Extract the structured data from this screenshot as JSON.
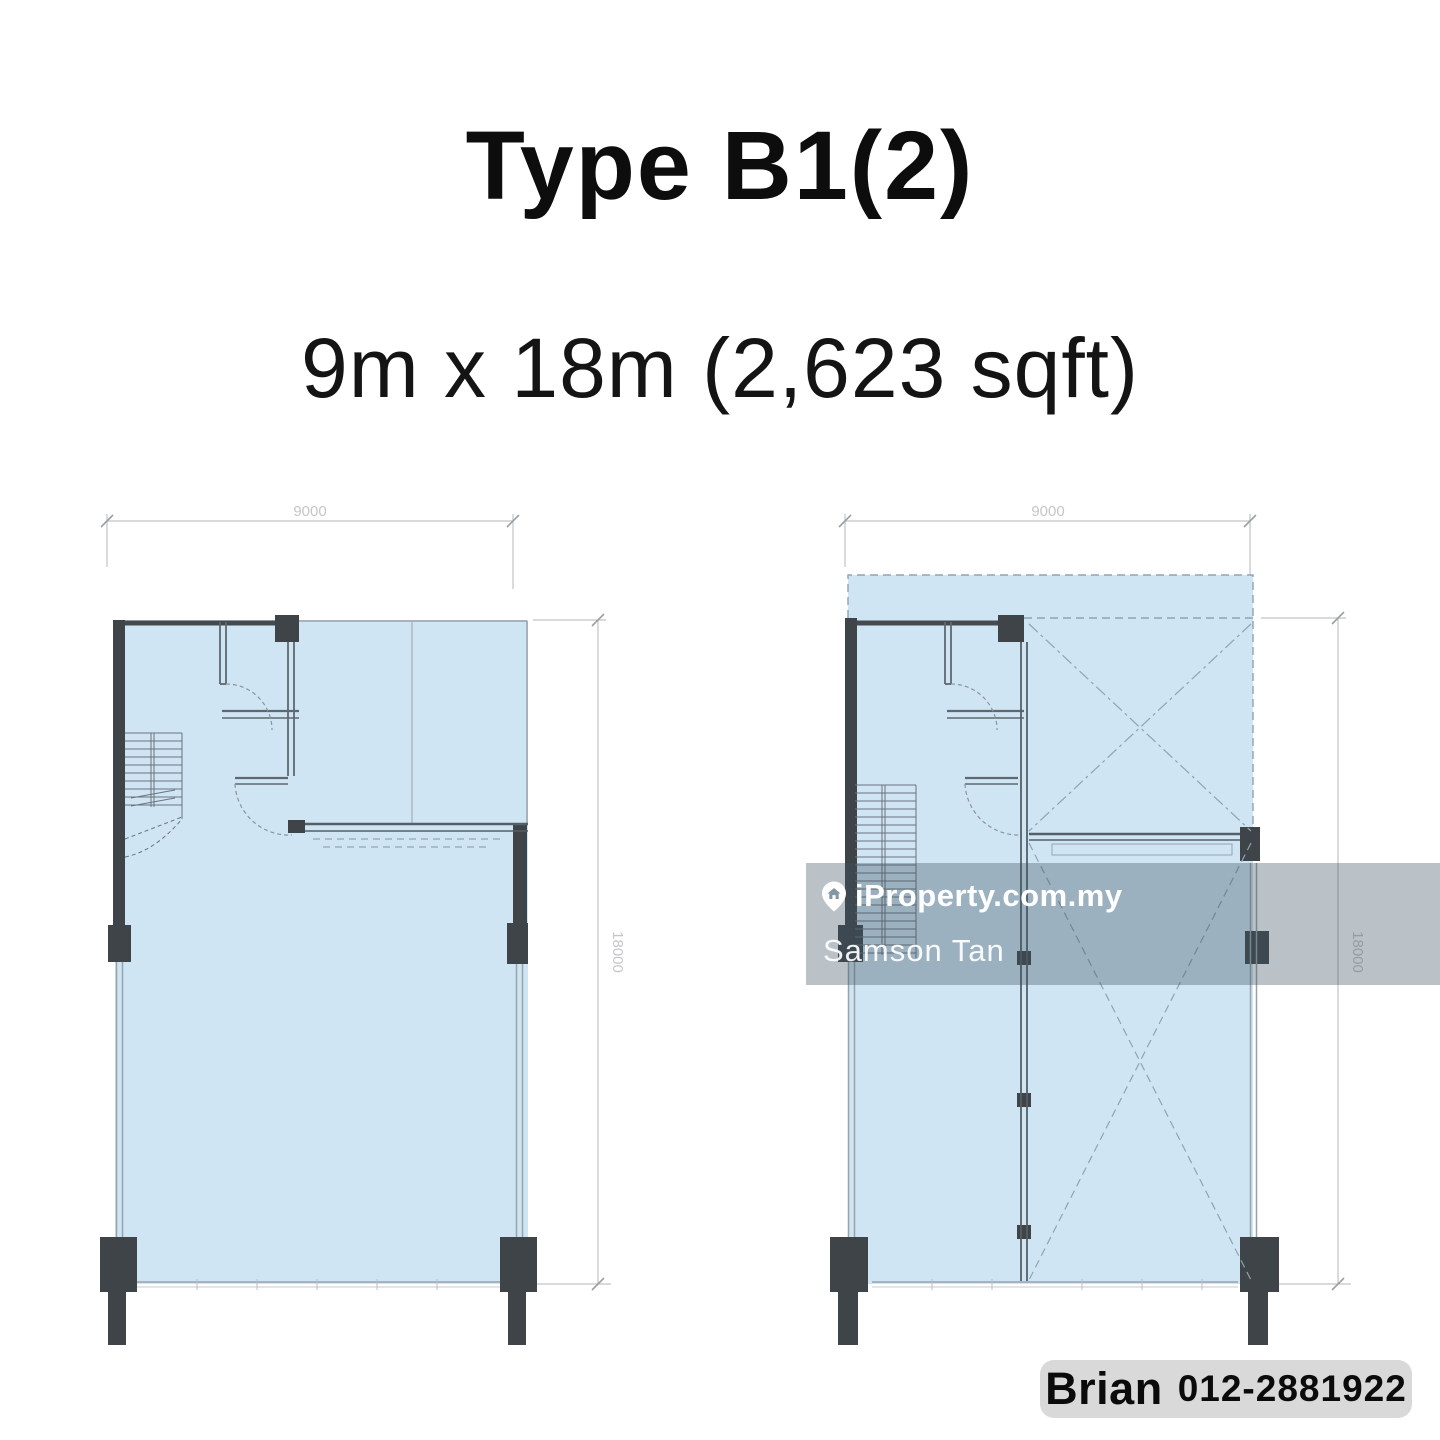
{
  "header": {
    "title": "Type B1(2)",
    "subtitle": "9m x 18m (2,623 sqft)"
  },
  "plans": {
    "left": {
      "width_dim": "9000",
      "height_dim": "18000"
    },
    "right": {
      "width_dim": "9000",
      "height_dim": "18000"
    }
  },
  "watermark": {
    "brand": "iProperty.com.my",
    "agent": "Samson Tan"
  },
  "contact": {
    "name": "Brian",
    "phone": "012-2881922"
  },
  "colors": {
    "floor_fill": "#cfe5f4",
    "wall_dark": "#3f4449",
    "interior_wall": "#5f686f",
    "dim_gray": "#c4c6c8",
    "void_dash": "#8fa3b0",
    "overlay": "rgba(60,79,94,0.35)",
    "contact_bg": "#d9d9d9",
    "text_black": "#111111"
  }
}
